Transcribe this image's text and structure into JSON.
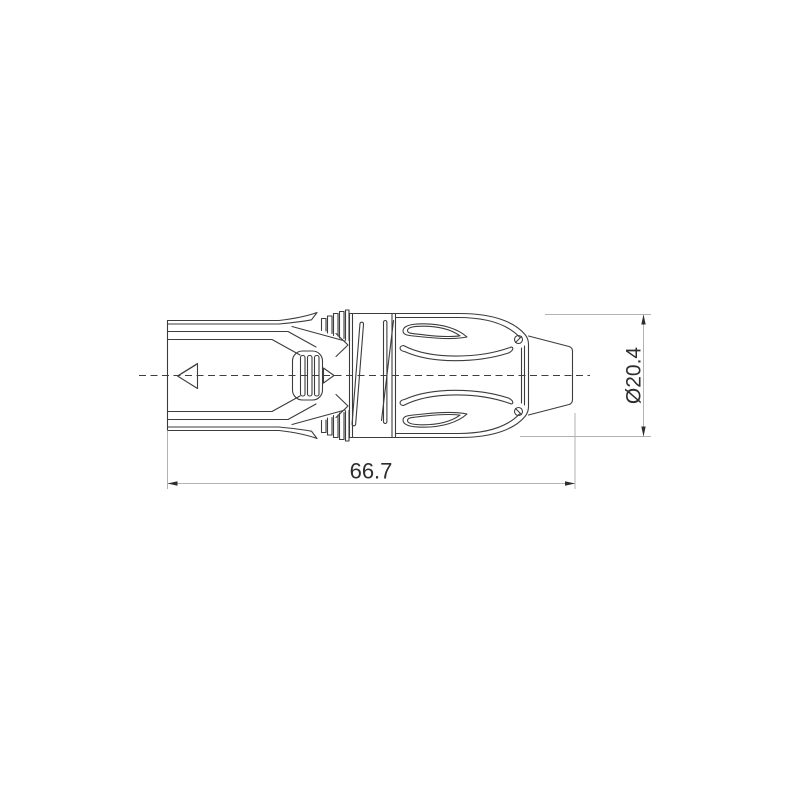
{
  "drawing": {
    "part_semantic": "cable-connector-side-view",
    "colors": {
      "outline": "#3c3c3c",
      "dimension_line": "#b2b2b2",
      "arrow_and_text": "#2d2d2d",
      "background": "#ffffff"
    }
  },
  "dimensions": {
    "length": {
      "label": "66.7"
    },
    "diameter": {
      "label": "Ø20.4"
    }
  }
}
